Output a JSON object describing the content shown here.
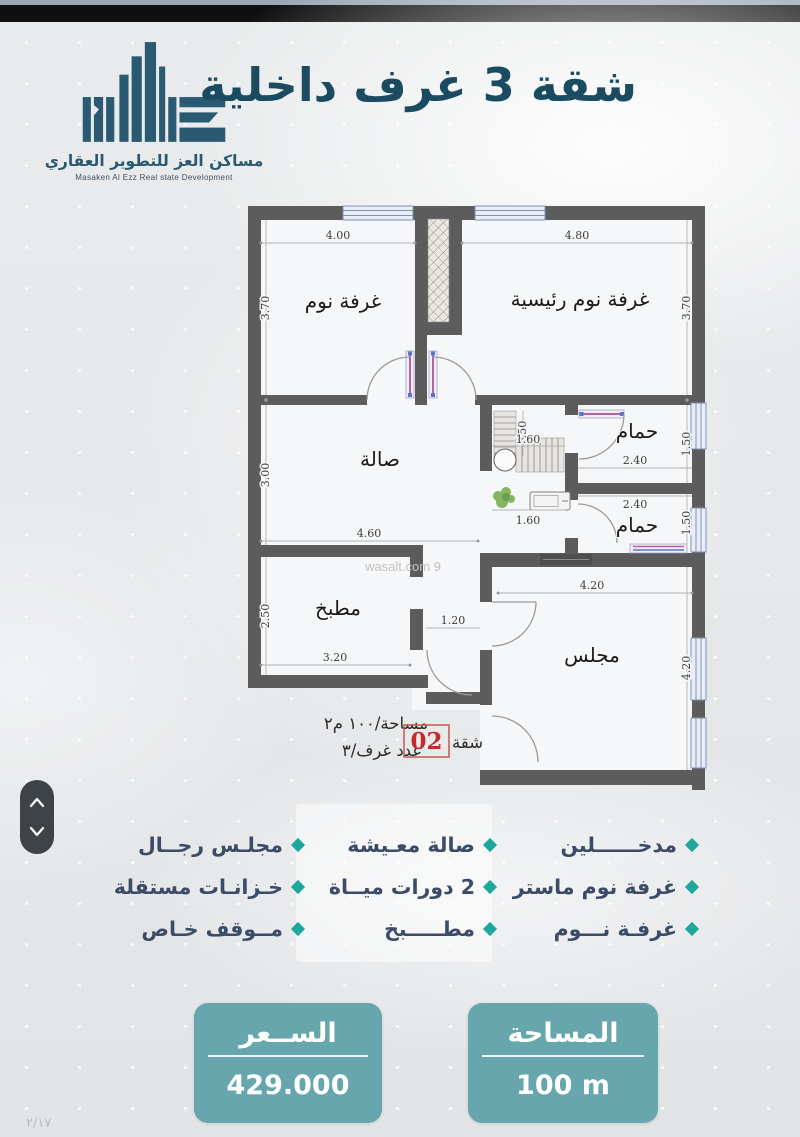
{
  "brand": {
    "name_ar": "مساكن العز للتطوير العقاري",
    "name_en": "Masaken Al Ezz Real state Development"
  },
  "header": {
    "title": "شقة 3 غرف داخلية"
  },
  "plan": {
    "watermark": "wasalt.com 9",
    "rooms": {
      "bedroom": "غرفة نوم",
      "master_bedroom": "غرفة نوم رئيسية",
      "hall": "صالة",
      "bathroom": "حمام",
      "kitchen": "مطبخ",
      "majlis": "مجلس"
    },
    "dims": {
      "bedroom_w": "4.00",
      "master_w": "4.80",
      "bedroom_h": "3.70",
      "hall_h": "3.00",
      "hall_w": "4.60",
      "corridor_h": "1.50",
      "corridor_w": "1.60",
      "bath_w": "2.40",
      "bath_h": "1.50",
      "kitchen_h": "2.50",
      "kitchen_w": "3.20",
      "passage_w": "1.20",
      "majlis_w": "4.20",
      "majlis_h": "4.20"
    },
    "annotation": {
      "area_line": "مساحة/١٠٠ م٢",
      "unit_label": "شقة",
      "unit_number": "02",
      "rooms_line": "عدد غرف/٣"
    }
  },
  "features": {
    "right": [
      "مدخــــــلين",
      "غرفة نوم ماستر",
      "غرفـة نـــوم"
    ],
    "middle": [
      "صالة معـيشة",
      "2 دورات ميــاة",
      "مطـــــبخ"
    ],
    "left": [
      "مجلـس رجــال",
      "خـزانـات مستقلة",
      "مــوقف خـاص"
    ]
  },
  "price_box": {
    "label": "الســعر",
    "value": "429.000"
  },
  "area_box": {
    "label": "المساحة",
    "value": "100 m"
  },
  "footer": {
    "page_marker": "٢/١٧"
  },
  "colors": {
    "accent_teal": "#1fa79b",
    "box_teal": "#68a6ad",
    "title_navy": "#1b4b61",
    "logo_slate": "#2a5a72",
    "wall_gray": "#5c5c5c",
    "unit_red": "#c32b2b"
  }
}
